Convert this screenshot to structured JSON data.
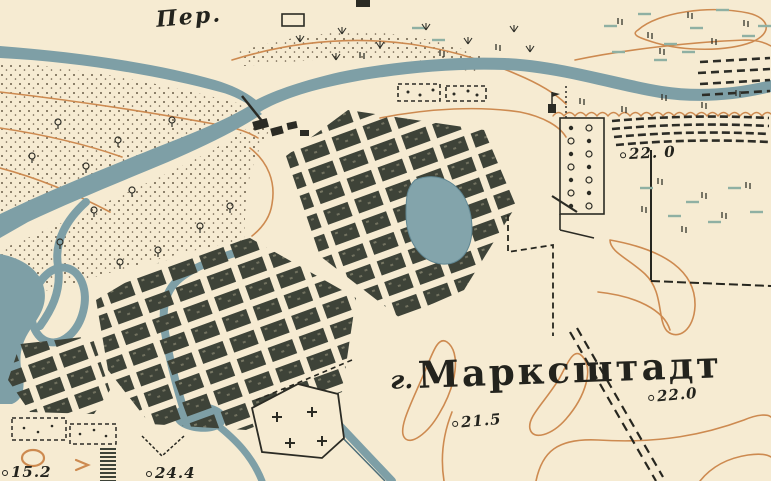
{
  "map": {
    "town_prefix": "г.",
    "town_name": "Марксштадт",
    "ferry_label": "Пер.",
    "spot_heights": [
      "22. 0",
      "21.5",
      "22.0",
      "15.2",
      "24.4"
    ],
    "palette": {
      "paper": "#f6ebd2",
      "water": "#7e9fa6",
      "water_dark": "#5f8591",
      "contour": "#cd8a50",
      "ink": "#2b2b24",
      "city_block": "#3e4338",
      "meadow_dash": "#8fb0a3",
      "sand_dot": "#5c4e3a"
    }
  }
}
